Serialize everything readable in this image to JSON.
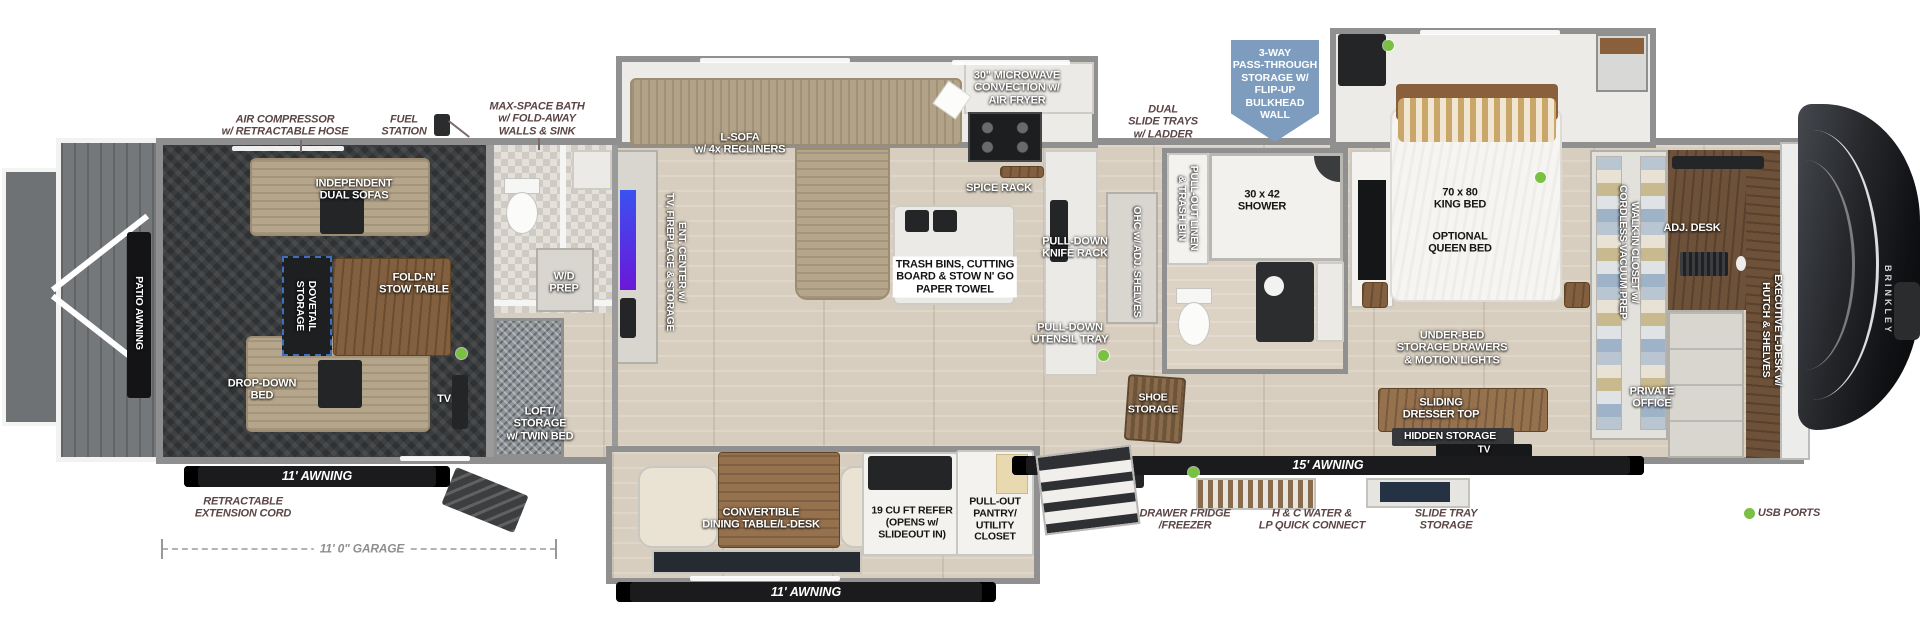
{
  "colors": {
    "label_maroon": "#5c4545",
    "label_white": "#ffffff",
    "accent_green": "#7ac143",
    "badge_blue": "#7e9dbe",
    "awning_black": "#1b1b1d"
  },
  "brand": {
    "name": "BRINKLEY"
  },
  "badge": {
    "text": "3-WAY\nPASS-THROUGH\nSTORAGE W/\nFLIP-UP\nBULKHEAD\nWALL"
  },
  "exterior": {
    "air_compressor": "AIR COMPRESSOR\nw/ RETRACTABLE HOSE",
    "fuel_station": "FUEL\nSTATION",
    "max_space_bath": "MAX-SPACE BATH\nw/ FOLD-AWAY\nWALLS & SINK",
    "retractable_cord": "RETRACTABLE\nEXTENSION CORD",
    "dual_slide_trays": "DUAL\nSLIDE TRAYS\nw/ LADDER",
    "drawer_fridge": "DRAWER FRIDGE\n/FREEZER",
    "water_lp": "H & C WATER &\nLP QUICK CONNECT",
    "slide_tray_storage": "SLIDE TRAY\nSTORAGE",
    "usb_ports": "USB PORTS",
    "garage_dim": "11' 0\" GARAGE",
    "awning_garage": "11' AWNING",
    "awning_dinette": "11' AWNING",
    "awning_main": "15' AWNING",
    "patio_awning": "PATIO AWNING"
  },
  "garage": {
    "dual_sofas": "INDEPENDENT\nDUAL SOFAS",
    "fold_table": "FOLD-N'\nSTOW TABLE",
    "dovetail": "DOVETAIL\nSTORAGE",
    "drop_down_bed": "DROP-DOWN\nBED",
    "tv": "TV"
  },
  "mid": {
    "wd_prep": "W/D\nPREP",
    "loft": "LOFT/\nSTORAGE\nw/ TWIN BED",
    "ent_center": "ENT. CENTER w/\nTV, FIREPLACE & STORAGE"
  },
  "living": {
    "l_sofa": "L-SOFA\nw/ 4x RECLINERS",
    "microwave": "30\" MICROWAVE\nCONVECTION w/\nAIR FRYER",
    "spice_rack": "SPICE RACK",
    "trash_bins": "TRASH BINS, CUTTING\nBOARD & STOW N' GO\nPAPER TOWEL",
    "knife_rack": "PULL-DOWN\nKNIFE RACK",
    "utensil_tray": "PULL-DOWN\nUTENSIL TRAY",
    "ohc": "OHC w/ ADJ. SHELVES",
    "dining": "CONVERTIBLE\nDINING TABLE/L-DESK",
    "refer": "19 CU FT REFER\n(OPENS w/\nSLIDEOUT IN)",
    "pantry": "PULL-OUT\nPANTRY/\nUTILITY\nCLOSET",
    "shoe_storage": "SHOE\nSTORAGE"
  },
  "bath": {
    "linen": "PULL-OUT LINEN\n& TRASH BIN",
    "shower": "30 x 42\nSHOWER"
  },
  "bedroom": {
    "king_bed": "70 x 80\nKING BED",
    "queen_opt": "OPTIONAL\nQUEEN BED",
    "under_bed": "UNDER-BED\nSTORAGE DRAWERS\n& MOTION LIGHTS",
    "dresser": "SLIDING\nDRESSER TOP",
    "hidden_storage": "HIDDEN STORAGE",
    "tv": "TV"
  },
  "office": {
    "walk_in": "WALK-IN CLOSET w/\nCORDLESS VACUUM PREP",
    "adj_desk": "ADJ. DESK",
    "private_office": "PRIVATE\nOFFICE",
    "exec_desk": "EXECUTIVE L-DESK w/\nHUTCH & SHELVES"
  }
}
